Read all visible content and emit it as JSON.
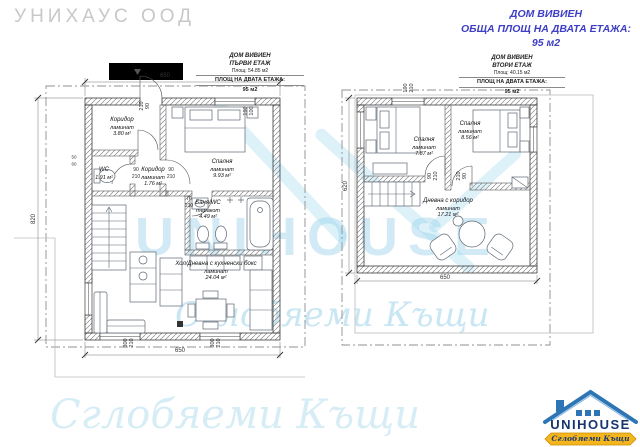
{
  "watermarks": {
    "corner": "УНИХАУС ООД",
    "big": "UNIHOUSE",
    "script": "Сглобяеми Къщи",
    "script_bottom": "Сглобяеми Къщи"
  },
  "header": {
    "project": "ДОМ ВИВИЕН",
    "total_label": "ОБЩА ПЛОЩ НА ДВАТА ЕТАЖА:",
    "total_value": "95 м2"
  },
  "floor1": {
    "title": {
      "project": "ДОМ ВИВИЕН",
      "floor": "ПЪРВИ ЕТАЖ",
      "area": "Площ: 54.85 м2",
      "total_label": "ПЛОЩ НА ДВАТА ЕТАЖА:",
      "total_value": "95 м2"
    },
    "rooms": {
      "corridor": {
        "name": "Коридор",
        "finish": "ламинат",
        "area": "3.80 м²"
      },
      "bedroom": {
        "name": "Спалня",
        "finish": "ламинат",
        "area": "9.93 м²"
      },
      "wc": {
        "name": "WC",
        "area": "1.91 м²"
      },
      "hall": {
        "name": "Коридор",
        "finish": "ламинат",
        "area": "1.76 м²"
      },
      "bath": {
        "name": "Баня/WC",
        "finish": "теракот",
        "area": "4.49 м²"
      },
      "living": {
        "name": "Хол/Дневна с кухненски бокс",
        "finish": "ламинат",
        "area": "24.04 м²"
      }
    },
    "dims": {
      "top": "650",
      "bottom": "650",
      "left": "820",
      "d50": "50",
      "d60": "60",
      "entry_door": [
        "210",
        "90"
      ],
      "top_window": [
        "190",
        "100"
      ],
      "hall_door_left": [
        "90",
        "210"
      ],
      "hall_door_right": [
        "90",
        "210"
      ],
      "bath_door": [
        "70",
        "210"
      ],
      "window1": [
        "300",
        "210"
      ],
      "window2": [
        "300",
        "210"
      ]
    }
  },
  "floor2": {
    "title": {
      "project": "ДОМ ВИВИЕН",
      "floor": "ВТОРИ ЕТАЖ",
      "area": "Площ: 40.15 м2",
      "total_label": "ПЛОЩ НА ДВАТА ЕТАЖА:",
      "total_value": "95 м2"
    },
    "rooms": {
      "bedroom1": {
        "name": "Спалня",
        "finish": "ламинат",
        "area": "7.87 м²"
      },
      "bedroom2": {
        "name": "Спалня",
        "finish": "ламинат",
        "area": "8.56 м²"
      },
      "living": {
        "name": "Дневна с коридор",
        "finish": "ламинат",
        "area": "17.21 м²"
      }
    },
    "dims": {
      "left": "620",
      "bottom": "650",
      "door1": [
        "90",
        "210"
      ],
      "door2": [
        "210",
        "90"
      ],
      "top_window": [
        "190",
        "210"
      ]
    }
  },
  "logo": {
    "name": "UNIHOUSE",
    "tagline": "Сглобяеми Къщи"
  }
}
